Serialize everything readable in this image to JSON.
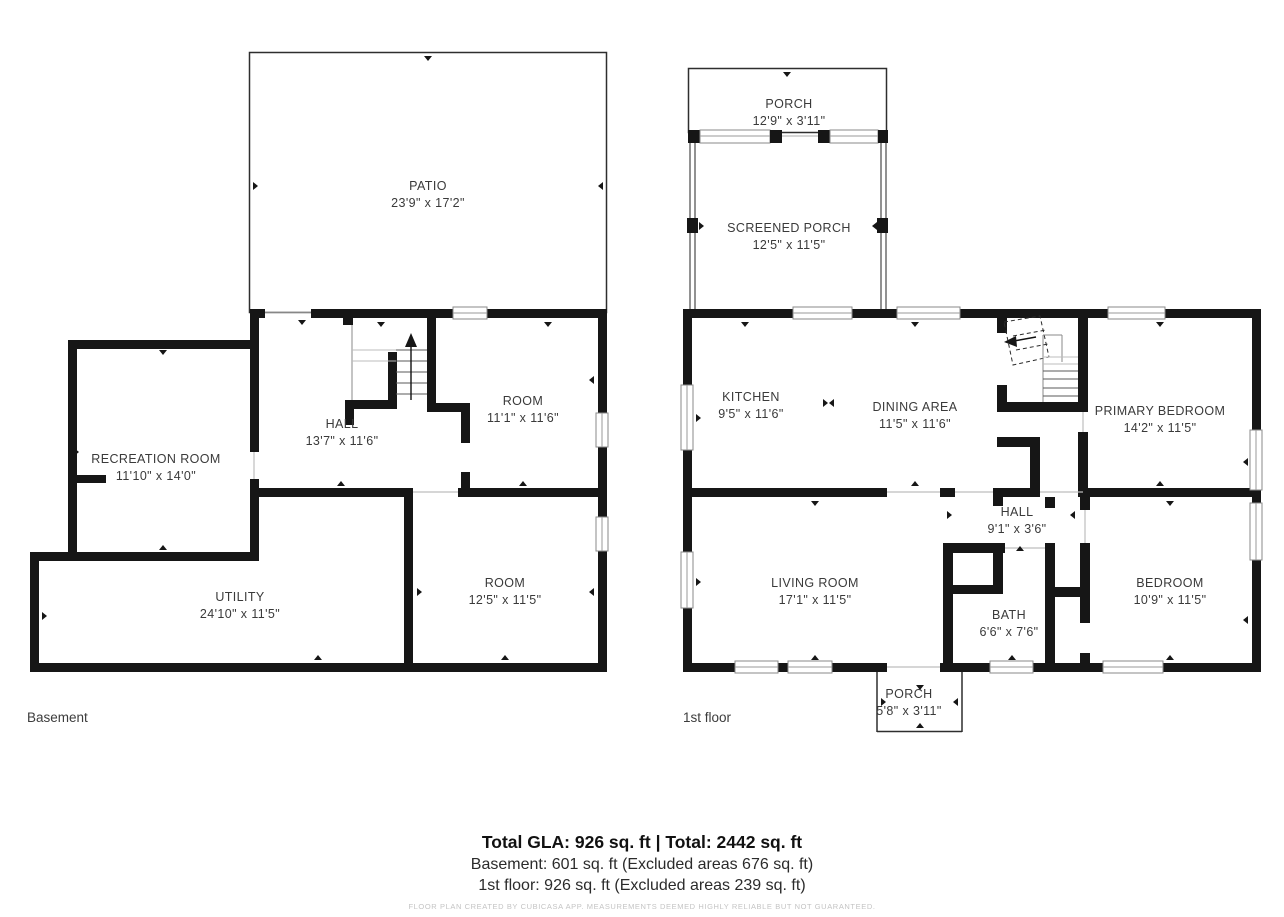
{
  "basement": {
    "floor_label": "Basement",
    "rooms": [
      {
        "name": "PATIO",
        "dims": "23'9\" x 17'2\""
      },
      {
        "name": "RECREATION ROOM",
        "dims": "11'10\" x 14'0\""
      },
      {
        "name": "HALL",
        "dims": "13'7\" x 11'6\""
      },
      {
        "name": "ROOM",
        "dims": "11'1\" x 11'6\""
      },
      {
        "name": "UTILITY",
        "dims": "24'10\" x 11'5\""
      },
      {
        "name": "ROOM",
        "dims": "12'5\" x 11'5\""
      }
    ]
  },
  "first_floor": {
    "floor_label": "1st floor",
    "rooms": [
      {
        "name": "PORCH",
        "dims": "12'9\" x 3'11\""
      },
      {
        "name": "SCREENED PORCH",
        "dims": "12'5\" x 11'5\""
      },
      {
        "name": "KITCHEN",
        "dims": "9'5\" x 11'6\""
      },
      {
        "name": "DINING AREA",
        "dims": "11'5\" x 11'6\""
      },
      {
        "name": "PRIMARY BEDROOM",
        "dims": "14'2\" x 11'5\""
      },
      {
        "name": "LIVING ROOM",
        "dims": "17'1\" x 11'5\""
      },
      {
        "name": "HALL",
        "dims": "9'1\" x 3'6\""
      },
      {
        "name": "BATH",
        "dims": "6'6\" x 7'6\""
      },
      {
        "name": "BEDROOM",
        "dims": "10'9\" x 11'5\""
      },
      {
        "name": "PORCH",
        "dims": "5'8\" x 3'11\""
      }
    ]
  },
  "summary": {
    "total_line": "Total GLA: 926 sq. ft | Total: 2442 sq. ft",
    "basement_line": "Basement: 601 sq. ft (Excluded areas 676 sq. ft)",
    "first_floor_line": "1st floor: 926 sq. ft (Excluded areas 239 sq. ft)",
    "disclaimer": "FLOOR PLAN CREATED BY CUBICASA APP. MEASUREMENTS DEEMED HIGHLY RELIABLE BUT NOT GUARANTEED."
  },
  "colors": {
    "wall": "#161616",
    "window_frame": "#8a8a8a",
    "label_text": "#3a3a3a",
    "disclaimer_text": "#c4c4c4"
  }
}
